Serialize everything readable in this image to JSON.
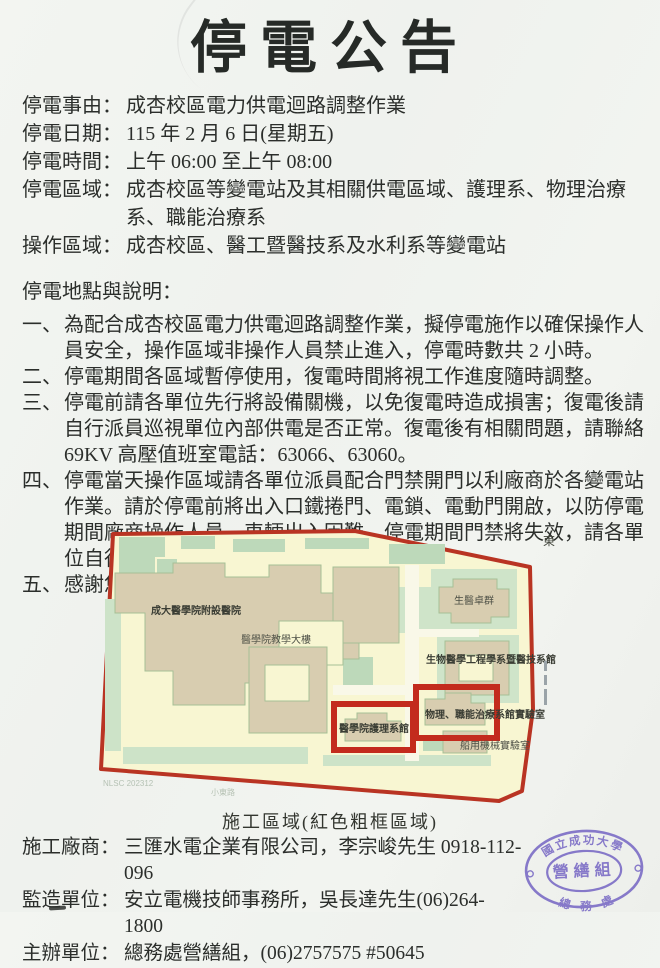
{
  "title": "停電公告",
  "info": [
    {
      "label": "停電事由：",
      "value": "成杏校區電力供電迴路調整作業"
    },
    {
      "label": "停電日期：",
      "value": "115 年 2 月 6 日(星期五)"
    },
    {
      "label": "停電時間：",
      "value": "上午 06:00 至上午 08:00"
    },
    {
      "label": "停電區域：",
      "value": "成杏校區等變電站及其相關供電區域、護理系、物理治療系、職能治療系"
    },
    {
      "label": "操作區域：",
      "value": "成杏校區、醫工暨醫技系及水利系等變電站"
    }
  ],
  "section_heading": "停電地點與說明：",
  "notes": [
    {
      "num": "一、",
      "text": "為配合成杏校區電力供電迴路調整作業，擬停電施作以確保操作人員安全，操作區域非操作人員禁止進入，停電時數共 2 小時。"
    },
    {
      "num": "二、",
      "text": "停電期間各區域暫停使用，復電時間將視工作進度隨時調整。"
    },
    {
      "num": "三、",
      "text": "停電前請各單位先行將設備關機，以免復電時造成損害；復電後請自行派員巡視單位內部供電是否正常。復電後有相關問題，請聯絡 69KV 高壓值班室電話：63066、63060。"
    },
    {
      "num": "四、",
      "text": "停電當天操作區域請各單位派員配合門禁開門以利廠商於各變電站作業。請於停電前將出入口鐵捲門、電鎖、電動門開啟，以防停電期間廠商操作人員、車輛出入困難。停電期間門禁將失效，請各單位自行提前因應。"
    },
    {
      "num": "五、",
      "text": "感謝您的配合，造成不便，敬請見諒。"
    }
  ],
  "map": {
    "caption": "施工區域(紅色粗框區域)",
    "compass": "東",
    "labels": {
      "hospital": "成大醫學院附設醫院",
      "teaching": "醫學院教學大樓",
      "biomed_cluster": "生醫卓群",
      "biomed_eng": "生物醫學工程學系暨醫技系館",
      "nursing": "醫學院護理系館",
      "physio": "物理、職能治療系館實驗室",
      "marine": "船用機械實驗室",
      "watermark": "NLSC 202312",
      "road": "小東路"
    },
    "colors": {
      "boundary_red": "#b93423",
      "highlight_red": "#c32b1d",
      "map_bg": "#f8f6d2",
      "building_tan": "#d8cdb0",
      "green": "#bdd9ba"
    }
  },
  "footer": [
    {
      "label": "施工廠商：",
      "value": "三匯水電企業有限公司，李宗峻先生 0918-112-096"
    },
    {
      "label": "監造單位：",
      "value": "安立電機技師事務所，吳長達先生(06)264-1800"
    },
    {
      "label": "主辦單位：",
      "value": "總務處營繕組，(06)2757575 #50645"
    }
  ],
  "stamp": {
    "outer_top": "國立成功大學",
    "outer_bottom": "總　務　處",
    "center": "營繕組",
    "color": "#8679c9"
  }
}
